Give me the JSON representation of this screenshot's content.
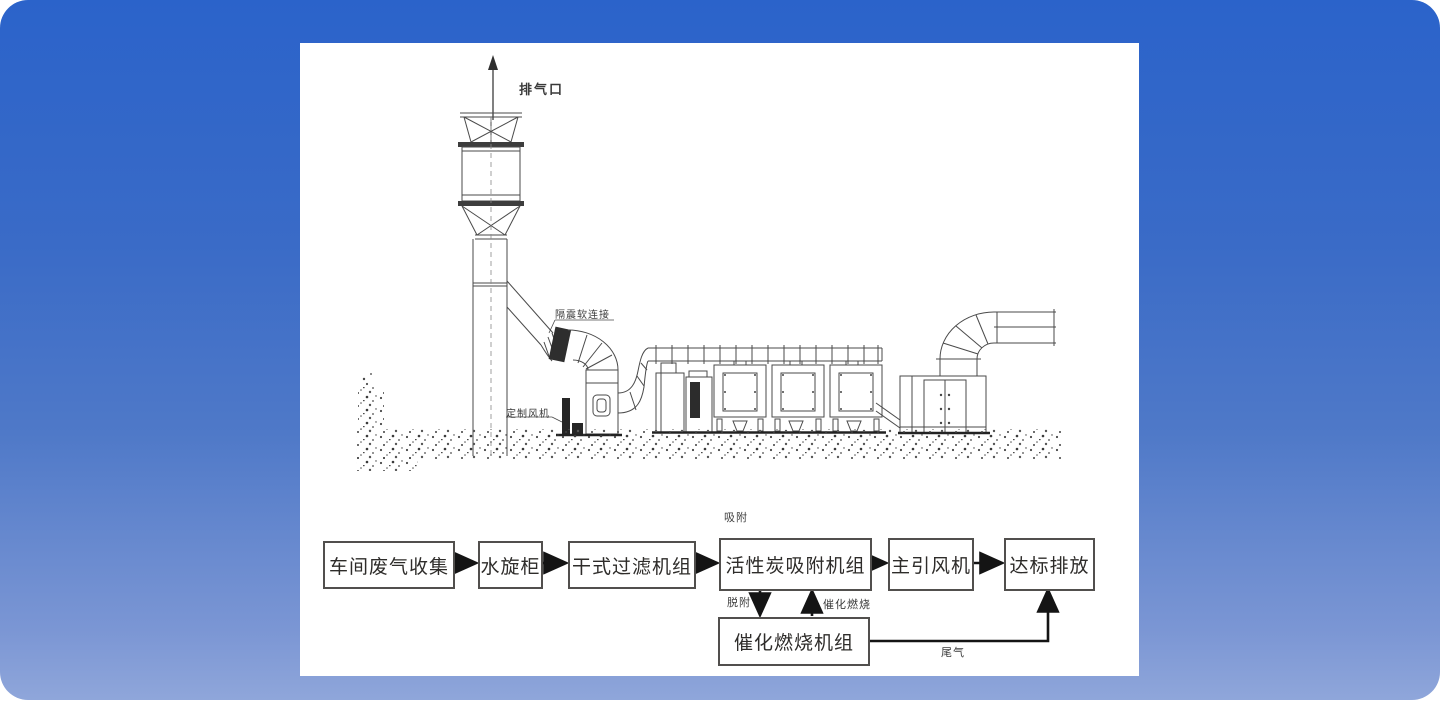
{
  "colors": {
    "bg-top": "#2b63ca",
    "bg-bottom": "#8fa6da",
    "panel-bg": "#ffffff",
    "line": "#4a4a4a",
    "arrow": "#141414"
  },
  "diagram": {
    "labels": {
      "exhaust_outlet": "排气口",
      "vibration_flex_joint": "隔震软连接",
      "custom_fan": "定制风机"
    }
  },
  "flowchart": {
    "boxes": [
      {
        "label": "车间废气收集"
      },
      {
        "label": "水旋柜"
      },
      {
        "label": "干式过滤机组"
      },
      {
        "label": "活性炭吸附机组"
      },
      {
        "label": "主引风机"
      },
      {
        "label": "达标排放"
      },
      {
        "label": "催化燃烧机组"
      }
    ],
    "annotations": {
      "adsorption": "吸附",
      "desorption": "脱附",
      "catalytic_combustion": "催化燃烧",
      "tail_gas": "尾气"
    }
  }
}
